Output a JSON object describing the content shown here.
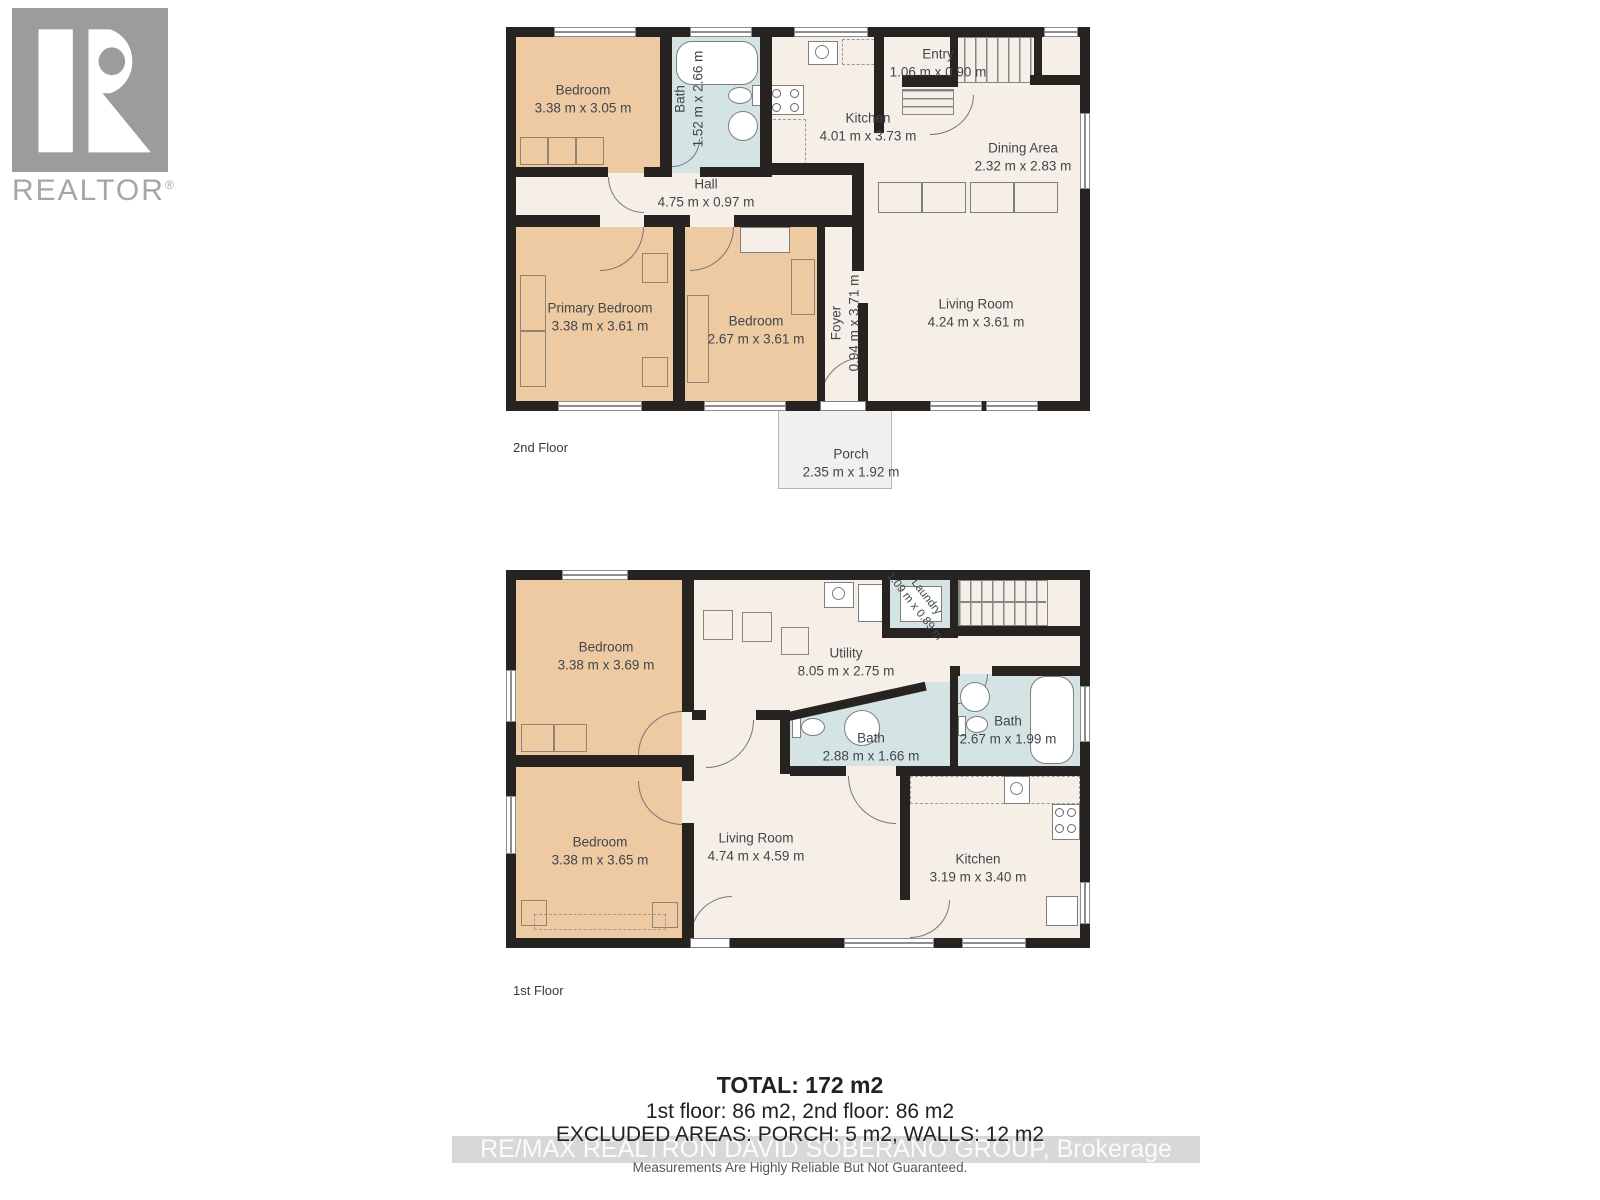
{
  "logo": {
    "title": "REALTOR",
    "reg": "®"
  },
  "floor2": {
    "label": "2nd Floor",
    "rooms": {
      "bedroom1": {
        "name": "Bedroom",
        "dims": "3.38 m x 3.05 m"
      },
      "bath": {
        "name": "Bath",
        "dims": "1.52 m x 2.66 m"
      },
      "kitchen": {
        "name": "Kitchen",
        "dims": "4.01 m x 3.73 m"
      },
      "entry": {
        "name": "Entry",
        "dims": "1.06 m x 0.90 m"
      },
      "dining": {
        "name": "Dining Area",
        "dims": "2.32 m x 2.83 m"
      },
      "hall": {
        "name": "Hall",
        "dims": "4.75 m x 0.97 m"
      },
      "primary": {
        "name": "Primary Bedroom",
        "dims": "3.38 m x 3.61 m"
      },
      "bedroom2": {
        "name": "Bedroom",
        "dims": "2.67 m x 3.61 m"
      },
      "foyer": {
        "name": "Foyer",
        "dims": "0.94 m x 3.71 m"
      },
      "living": {
        "name": "Living Room",
        "dims": "4.24 m x 3.61 m"
      },
      "porch": {
        "name": "Porch",
        "dims": "2.35 m x 1.92 m"
      }
    }
  },
  "floor1": {
    "label": "1st Floor",
    "rooms": {
      "bedroom1": {
        "name": "Bedroom",
        "dims": "3.38 m x 3.69 m"
      },
      "utility": {
        "name": "Utility",
        "dims": "8.05 m x 2.75 m"
      },
      "laundry": {
        "name": "Laundry",
        "dims": "1.09 m x 0.89 m"
      },
      "bath1": {
        "name": "Bath",
        "dims": "2.88 m x 1.66 m"
      },
      "bath2": {
        "name": "Bath",
        "dims": "2.67 m x 1.99 m"
      },
      "bedroom2": {
        "name": "Bedroom",
        "dims": "3.38 m x 3.65 m"
      },
      "living": {
        "name": "Living Room",
        "dims": "4.74 m x 4.59 m"
      },
      "kitchen": {
        "name": "Kitchen",
        "dims": "3.19 m x 3.40 m"
      }
    }
  },
  "summary": {
    "total": "TOTAL: 172 m2",
    "floors": "1st floor: 86 m2, 2nd floor: 86 m2",
    "excluded": "EXCLUDED AREAS: PORCH: 5 m2, WALLS: 12 m2",
    "watermark": "RE/MAX REALTRON DAVID SOBERANO GROUP, Brokerage",
    "disclaimer": "Measurements Are Highly Reliable But Not Guaranteed."
  },
  "colors": {
    "bedroom_fill": "#eecaa2",
    "bath_fill": "#d4e4e5",
    "room_fill": "#f6efe8",
    "wall": "#262320",
    "porch_fill": "#f0f0ee",
    "logo_gray": "#9c9c9c"
  }
}
